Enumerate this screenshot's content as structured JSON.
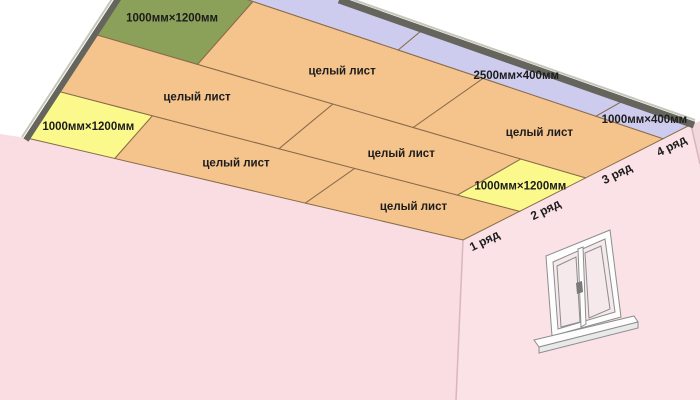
{
  "diagram_title": "ceiling-drywall-layout",
  "palette": {
    "sheet_orange": "#f5c38c",
    "sheet_yellow": "#fbf98b",
    "sheet_green": "#8ba058",
    "sheet_lavender": "#cdccee",
    "seam_brown": "#8a6b4a",
    "wall_pink": "#f9dde2",
    "wall_pink_right": "#fae2e6",
    "wall_pink_far": "#f2d7dc",
    "edge_dark": "#65655d",
    "edge_light": "#c6c6ba",
    "label_color": "#1c1c1c",
    "window_white": "#fdfdfd",
    "window_stroke": "#8d8d8d",
    "glass_pink": "#f6e9ec"
  },
  "ceiling": {
    "unit": "мм",
    "room_length_mm": 6000,
    "room_width_mm": 4000,
    "whole_sheet_label": "целый лист",
    "rows": [
      {
        "label": "1 ряд",
        "depth_mm": 1200,
        "sheets": [
          {
            "label": "1000мм×1200мм",
            "length_mm": 1000,
            "color": "sheet_yellow"
          },
          {
            "label": "целый лист",
            "length_mm": 2500,
            "color": "sheet_orange"
          },
          {
            "label": "целый лист",
            "length_mm": 2500,
            "color": "sheet_orange"
          }
        ]
      },
      {
        "label": "2 ряд",
        "depth_mm": 1200,
        "sheets": [
          {
            "label": "целый лист",
            "length_mm": 2500,
            "color": "sheet_orange"
          },
          {
            "label": "целый лист",
            "length_mm": 2500,
            "color": "sheet_orange"
          },
          {
            "label": "1000мм×1200мм",
            "length_mm": 1000,
            "color": "sheet_yellow"
          }
        ]
      },
      {
        "label": "3 ряд",
        "depth_mm": 1200,
        "sheets": [
          {
            "label": "1000мм×1200мм",
            "length_mm": 1000,
            "color": "sheet_green"
          },
          {
            "label": "целый лист",
            "length_mm": 2500,
            "color": "sheet_orange"
          },
          {
            "label": "целый лист",
            "length_mm": 2500,
            "color": "sheet_orange"
          }
        ]
      },
      {
        "label": "4 ряд",
        "depth_mm": 400,
        "sheets": [
          {
            "label": "",
            "length_mm": 2500,
            "color": "sheet_lavender"
          },
          {
            "label": "2500мм×400мм",
            "length_mm": 2500,
            "color": "sheet_lavender"
          },
          {
            "label": "1000мм×400мм",
            "length_mm": 1000,
            "color": "sheet_lavender"
          }
        ]
      }
    ]
  }
}
